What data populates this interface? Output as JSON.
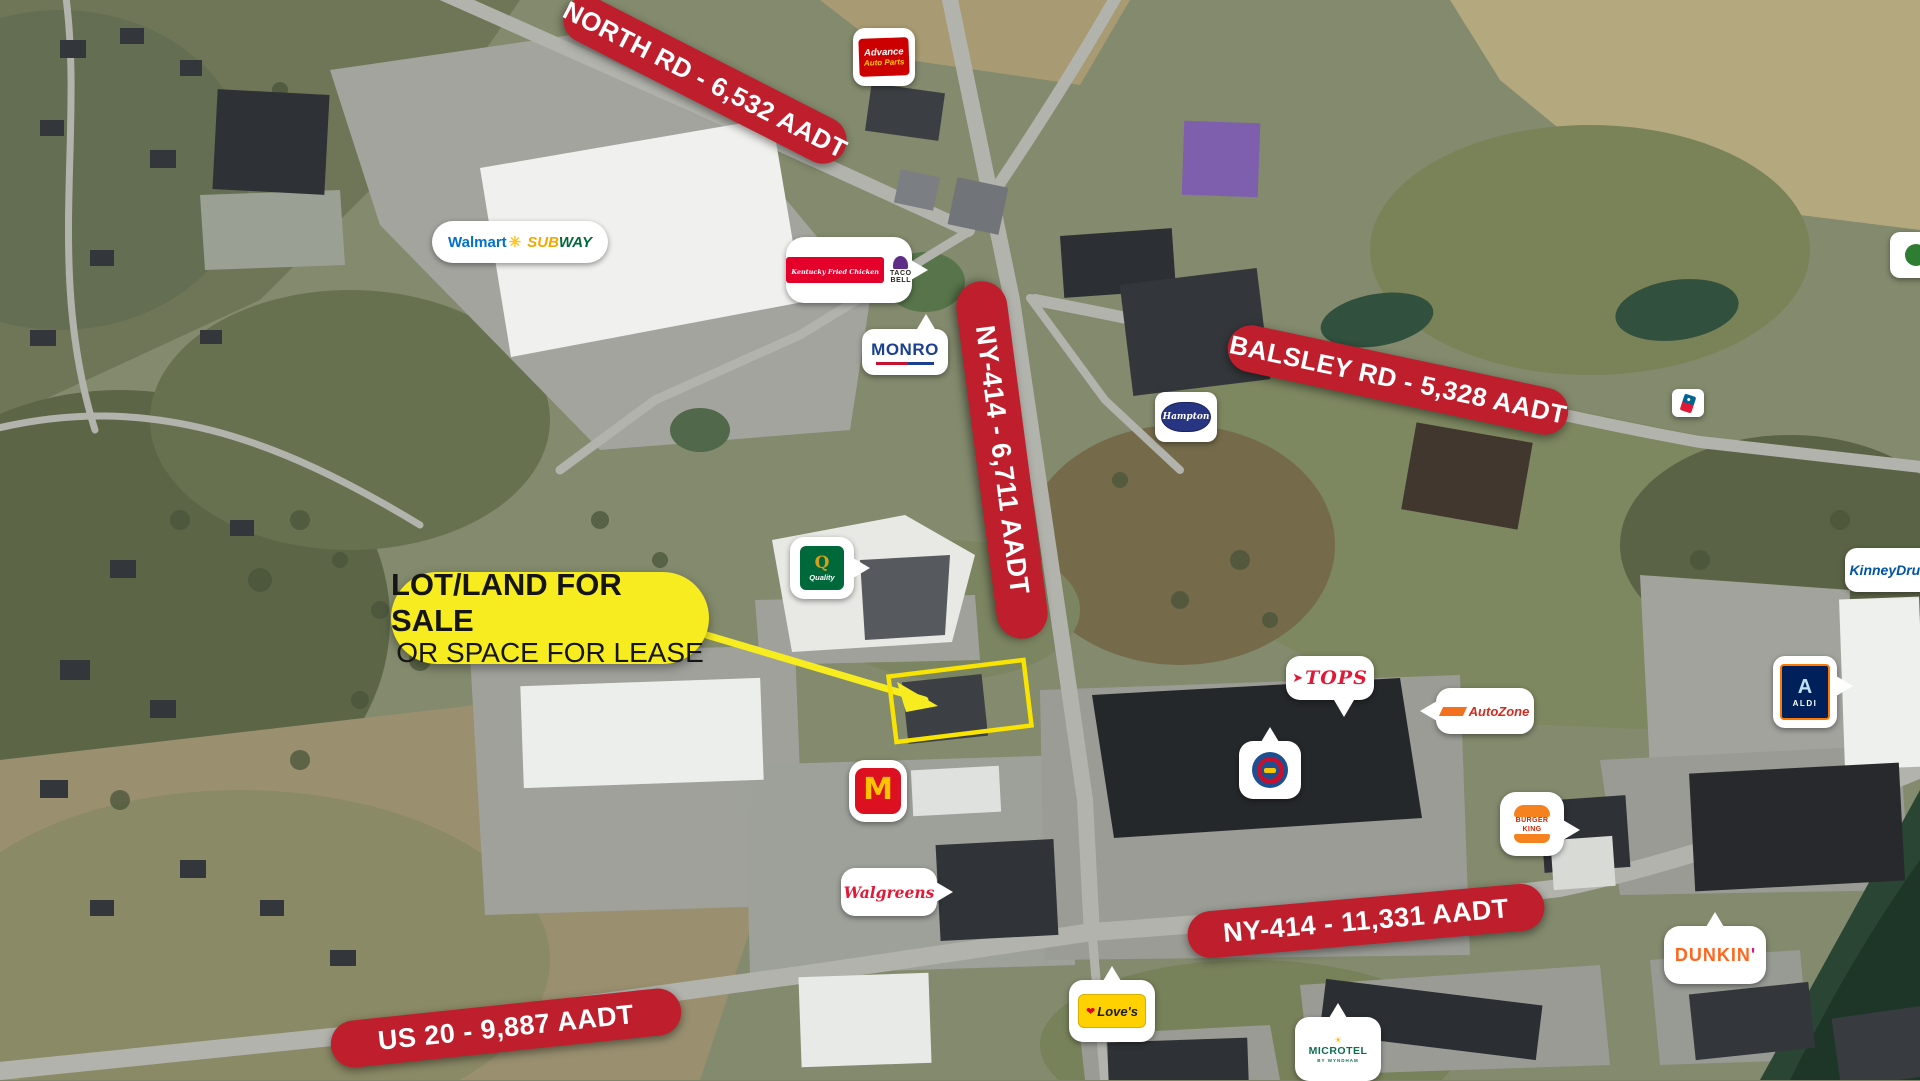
{
  "map_title": "Aerial retail trade-area map with traffic counts",
  "callout": {
    "line1": "LOT/LAND FOR SALE",
    "line2": "OR SPACE FOR LEASE"
  },
  "banners": {
    "north_rd": "NORTH RD - 6,532 AADT",
    "ny414_upper": "NY-414 - 6,711 AADT",
    "balsley_rd": "BALSLEY RD - 5,328 AADT",
    "ny414_lower": "NY-414 - 11,331 AADT",
    "us20": "US 20 - 9,887 AADT"
  },
  "logos": {
    "advance_auto": {
      "line1": "Advance",
      "line2": "Auto Parts"
    },
    "walmart": "Walmart",
    "subway": {
      "part1": "SUB",
      "part2": "WAY"
    },
    "kfc": "Kentucky Fried Chicken",
    "taco_bell": {
      "line1": "TACO",
      "line2": "BELL"
    },
    "monro": "MONRO",
    "hampton": "Hampton",
    "quality": {
      "letter": "Q",
      "name": "Quality"
    },
    "kinney": "KinneyDrugs",
    "tops": "TOPS",
    "autozone": "AutoZone",
    "aldi": {
      "letter": "A",
      "name": "ALDI"
    },
    "mcdonalds": "M",
    "burger_king": {
      "line1": "BURGER",
      "line2": "KING"
    },
    "walgreens": "Walgreens",
    "dunkin": {
      "name": "DUNKIN",
      "apostrophe": "'"
    },
    "loves": "Love's",
    "microtel": {
      "name": "MICROTEL",
      "sub": "BY WYNDHAM"
    }
  },
  "icons": {
    "walmart_spark": "✳",
    "tops_arrow": "➤",
    "loves_heart": "❤",
    "microtel_sun": "☀"
  },
  "colors": {
    "banner_red": "#bf1e2d",
    "callout_yellow": "#f7ec1f",
    "parcel_yellow": "#f9e300",
    "advance_red": "#cc0000",
    "advance_yellow": "#ffcf00",
    "walmart_blue": "#0071ce",
    "walmart_spark_yellow": "#ffc220",
    "subway_yellow": "#f2a900",
    "subway_green": "#00693c",
    "kfc_red": "#e4002b",
    "tacobell_purple": "#5f2c87",
    "monro_blue": "#1b3f92",
    "monro_red": "#c41230",
    "hampton_blue": "#283583",
    "quality_green": "#00693c",
    "quality_gold": "#d4a017",
    "kinney_blue": "#0054a4",
    "tops_red": "#e21836",
    "autozone_orange": "#f37021",
    "autozone_red": "#d52b1e",
    "aldi_blue": "#00205b",
    "aldi_orange": "#ff7800",
    "plaza_ring_blue": "#1d4f91",
    "plaza_ring_red": "#c8102e",
    "plaza_center_yellow": "#f6c500",
    "mcdonalds_red": "#dd1021",
    "mcdonalds_gold": "#ffc300",
    "bk_orange": "#f5821f",
    "bk_red": "#d62300",
    "walgreens_red": "#e31837",
    "dunkin_orange": "#ff671f",
    "dunkin_pink": "#da1884",
    "loves_yellow": "#ffd100",
    "loves_red": "#e4002b",
    "microtel_green": "#0b6e4f",
    "dominos_blue": "#006491",
    "dominos_red": "#e31837"
  }
}
